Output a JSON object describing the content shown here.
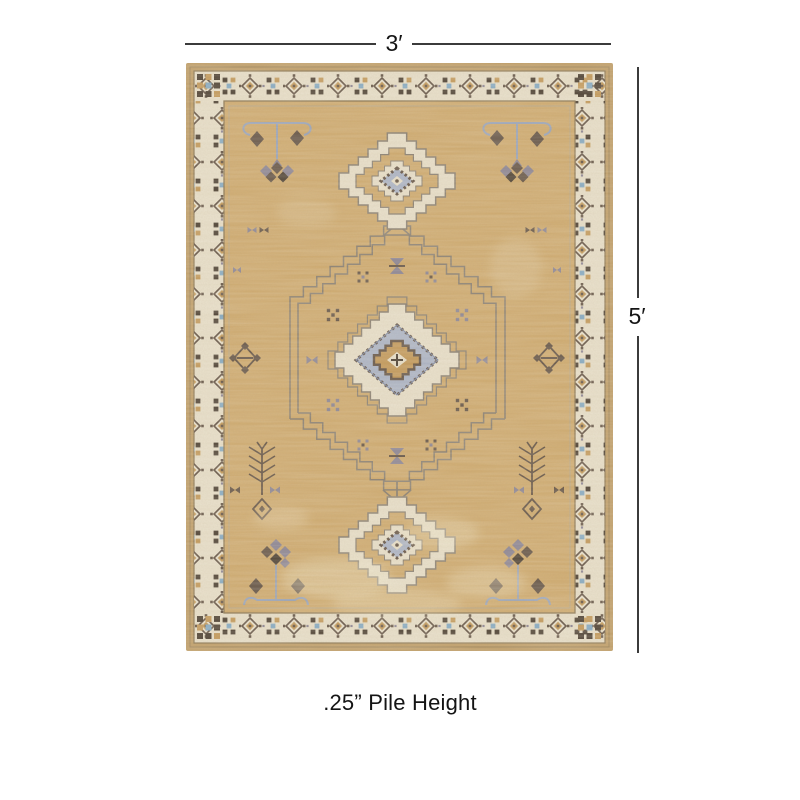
{
  "annotation": {
    "width_label": "3′",
    "height_label": "5′",
    "pile_height_label": ".25” Pile Height",
    "line_color": "#3b3b3b",
    "text_color": "#141414"
  },
  "rug": {
    "alt": "tan and cream geometric medallion area rug",
    "colors": {
      "edge": "#c1a06b",
      "cream": "#e7dec8",
      "field": "#cfab70",
      "line": "#8f7b58",
      "out": "#8c8274",
      "brown": "#675749",
      "dark": "#4f4336",
      "gold": "#c39a5c",
      "blue": "#adb5c6",
      "bluedk": "#7f89a1",
      "lav": "#9aa4b8",
      "gray": "#8d8694",
      "bblue": "#87abc3",
      "wear": "#f2e7cb"
    }
  }
}
